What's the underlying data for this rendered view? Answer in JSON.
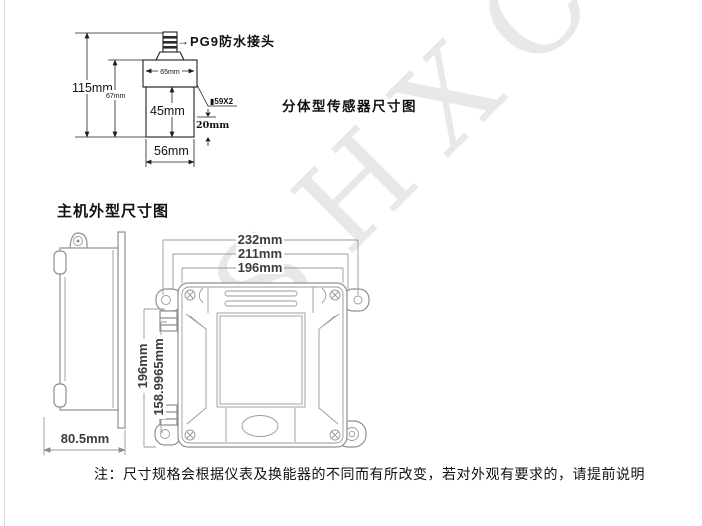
{
  "watermark": {
    "text": "SHXCK"
  },
  "sensor": {
    "title": "分体型传感器尺寸图",
    "connector_arrow": "→",
    "connector_label": "PG9防水接头",
    "dim_total_height": "115mm",
    "dim_upper_height": "67mm",
    "dim_top_width": "65mm",
    "dim_body_height": "45mm",
    "thread_label": "▮59X2",
    "dim_tip_height": "20mm",
    "dim_bottom_width": "56mm"
  },
  "main_unit": {
    "title": "主机外型尺寸图",
    "side": {
      "dim_depth": "80.5mm"
    },
    "front": {
      "dim_width_outer": "232mm",
      "dim_width_mid": "211mm",
      "dim_width_inner": "196mm",
      "dim_height_outer": "196mm",
      "dim_height_inner": "158.9965mm"
    }
  },
  "note": {
    "text": "注：尺寸规格会根据仪表及换能器的不同而有所改变，若对外观有要求的，请提前说明"
  },
  "colors": {
    "drawing_ink": "#1f1f1f",
    "unit_line": "#8f8f8f",
    "dim_text": "#3c3c3c",
    "watermark": "#e8e8e8"
  }
}
